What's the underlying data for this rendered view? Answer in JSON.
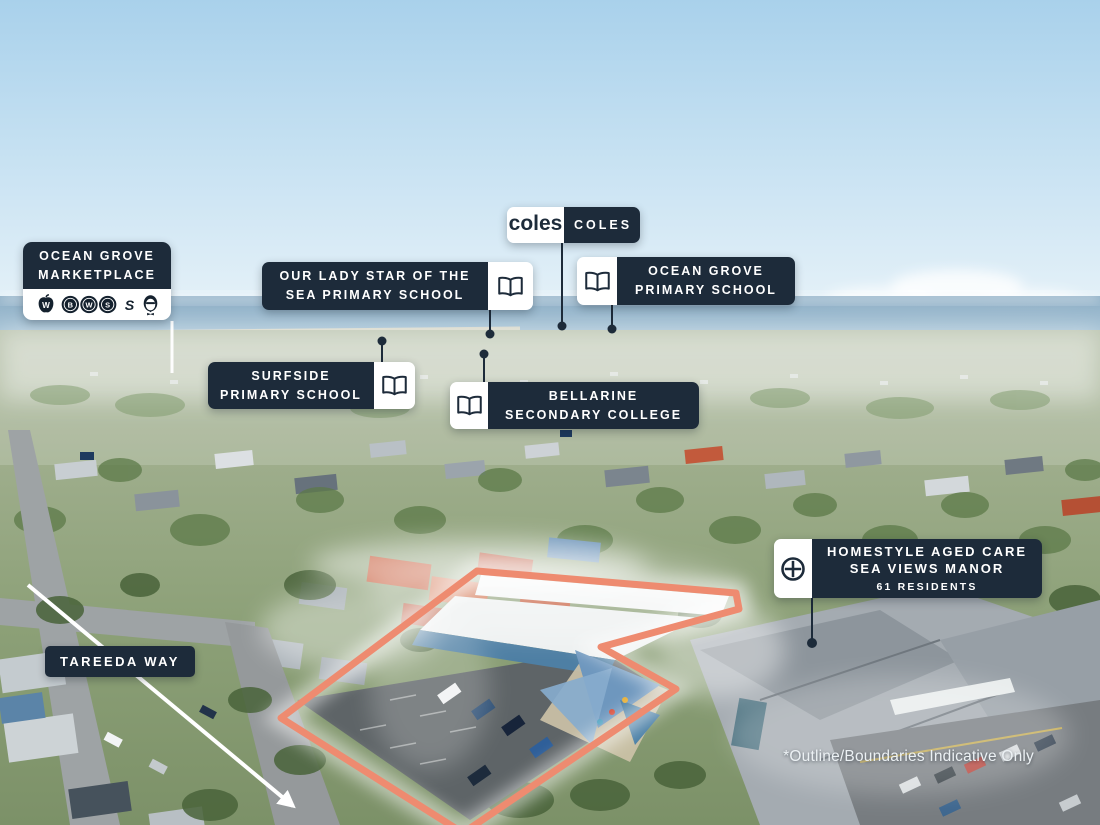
{
  "colors": {
    "navy": "#1D2B3A",
    "outline": "#EE8B70",
    "white": "#FFFFFF"
  },
  "labels": {
    "marketplace": {
      "line1": "OCEAN GROVE",
      "line2": "MARKETPLACE"
    },
    "coles": {
      "logo": "coles",
      "name": "COLES"
    },
    "our_lady": {
      "line1": "OUR LADY STAR OF THE",
      "line2": "SEA PRIMARY SCHOOL"
    },
    "ocean_grove_primary": {
      "line1": "OCEAN GROVE",
      "line2": "PRIMARY SCHOOL"
    },
    "surfside": {
      "line1": "SURFSIDE",
      "line2": "PRIMARY SCHOOL"
    },
    "bellarine": {
      "line1": "BELLARINE",
      "line2": "SECONDARY COLLEGE"
    },
    "homestyle": {
      "line1": "HOMESTYLE AGED CARE",
      "line2": "SEA VIEWS MANOR",
      "line3": "61 RESIDENTS"
    },
    "street": {
      "name": "TAREEDA WAY"
    },
    "disclaimer": "*Outline/Boundaries Indicative Only"
  },
  "brands": {
    "woolworths": {
      "icon": "woolworths-apple-icon",
      "letter": "W"
    },
    "bws": {
      "icon": "bws-circles-icon",
      "letters": [
        "B",
        "W",
        "S"
      ]
    },
    "subway": {
      "icon": "subway-s-icon",
      "letter": "S"
    },
    "kfc": {
      "icon": "kfc-colonel-icon"
    }
  },
  "icons": {
    "school": "open-book-icon",
    "aged_care": "medical-cross-icon"
  }
}
